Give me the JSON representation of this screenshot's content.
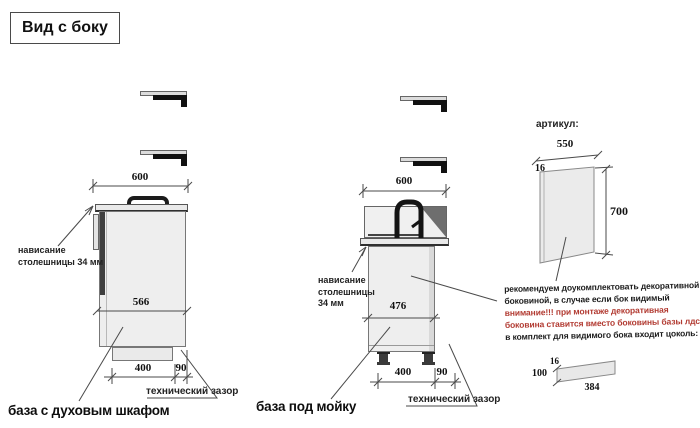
{
  "title": "Вид с боку",
  "colors": {
    "warning_red": "#b23b32",
    "drawing_line": "#4a4a4a",
    "cabinet_fill": "#eeeeee",
    "dark_panel": "#3f3f3f"
  },
  "cabinets": {
    "oven": {
      "label": "база с духовым шкафом",
      "overhang_note": [
        "нависание",
        "столешницы 34 мм"
      ],
      "gap_note": "технический зазор",
      "dim_top": "600",
      "dim_depth": "566",
      "dim_plinth": "400",
      "dim_gap": "90"
    },
    "sink": {
      "label": "база под мойку",
      "overhang_note": [
        "нависание",
        "столешницы",
        "34 мм"
      ],
      "gap_note": "технический зазор",
      "dim_top": "600",
      "dim_depth": "476",
      "dim_plinth": "400",
      "dim_gap": "90"
    }
  },
  "side_panel": {
    "article_label": "артикул:",
    "dim_width": "550",
    "dim_thickness": "16",
    "dim_height": "700",
    "note": [
      "рекомендуем доукомплектовать декоративной",
      "боковиной, в случае если бок видимый"
    ],
    "warning": [
      "внимание!!! при монтаже декоративная",
      "боковина ставится вместо боковины базы лдсп"
    ],
    "note2": "в комплект для видимого бока входит цоколь:"
  },
  "plinth": {
    "dim_thickness": "16",
    "dim_height": "100",
    "dim_length": "384"
  }
}
